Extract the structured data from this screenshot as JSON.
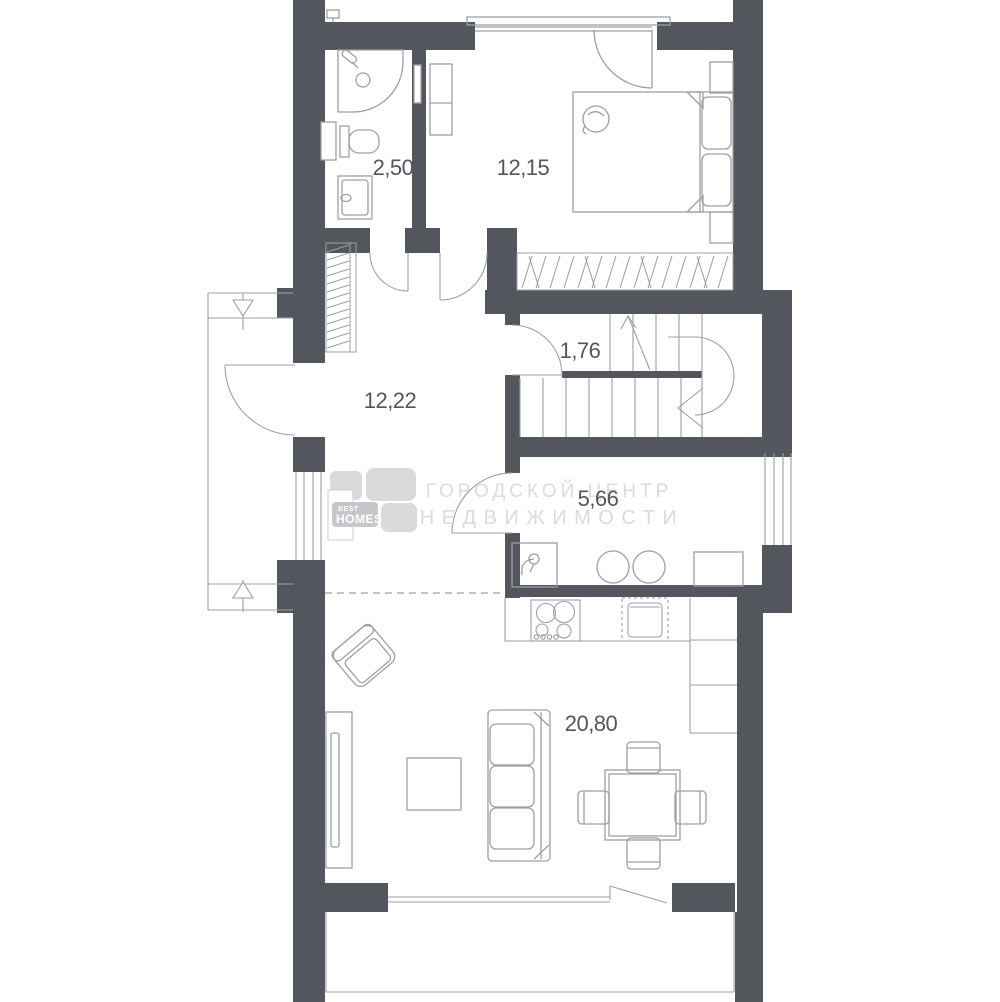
{
  "colors": {
    "wall": "#54565e",
    "line": "#9aa0a6",
    "line_light": "#c2c5c9",
    "text": "#53575d",
    "watermark": "#dadbdd",
    "logo_tile": "#d2d3d5"
  },
  "rooms": {
    "bathroom": {
      "area": "2,50"
    },
    "bedroom": {
      "area": "12,15"
    },
    "stair_landing": {
      "area": "1,76"
    },
    "hallway": {
      "area": "12,22"
    },
    "kitchen_niche": {
      "area": "5,66"
    },
    "living_room": {
      "area": "20,80"
    }
  },
  "watermark": {
    "line1": "ГОРОДСКОЙ ЦЕНТР",
    "line2": "НЕДВИЖИМОСТИ",
    "logo_top": "BEST",
    "logo_bottom": "HOMES"
  }
}
